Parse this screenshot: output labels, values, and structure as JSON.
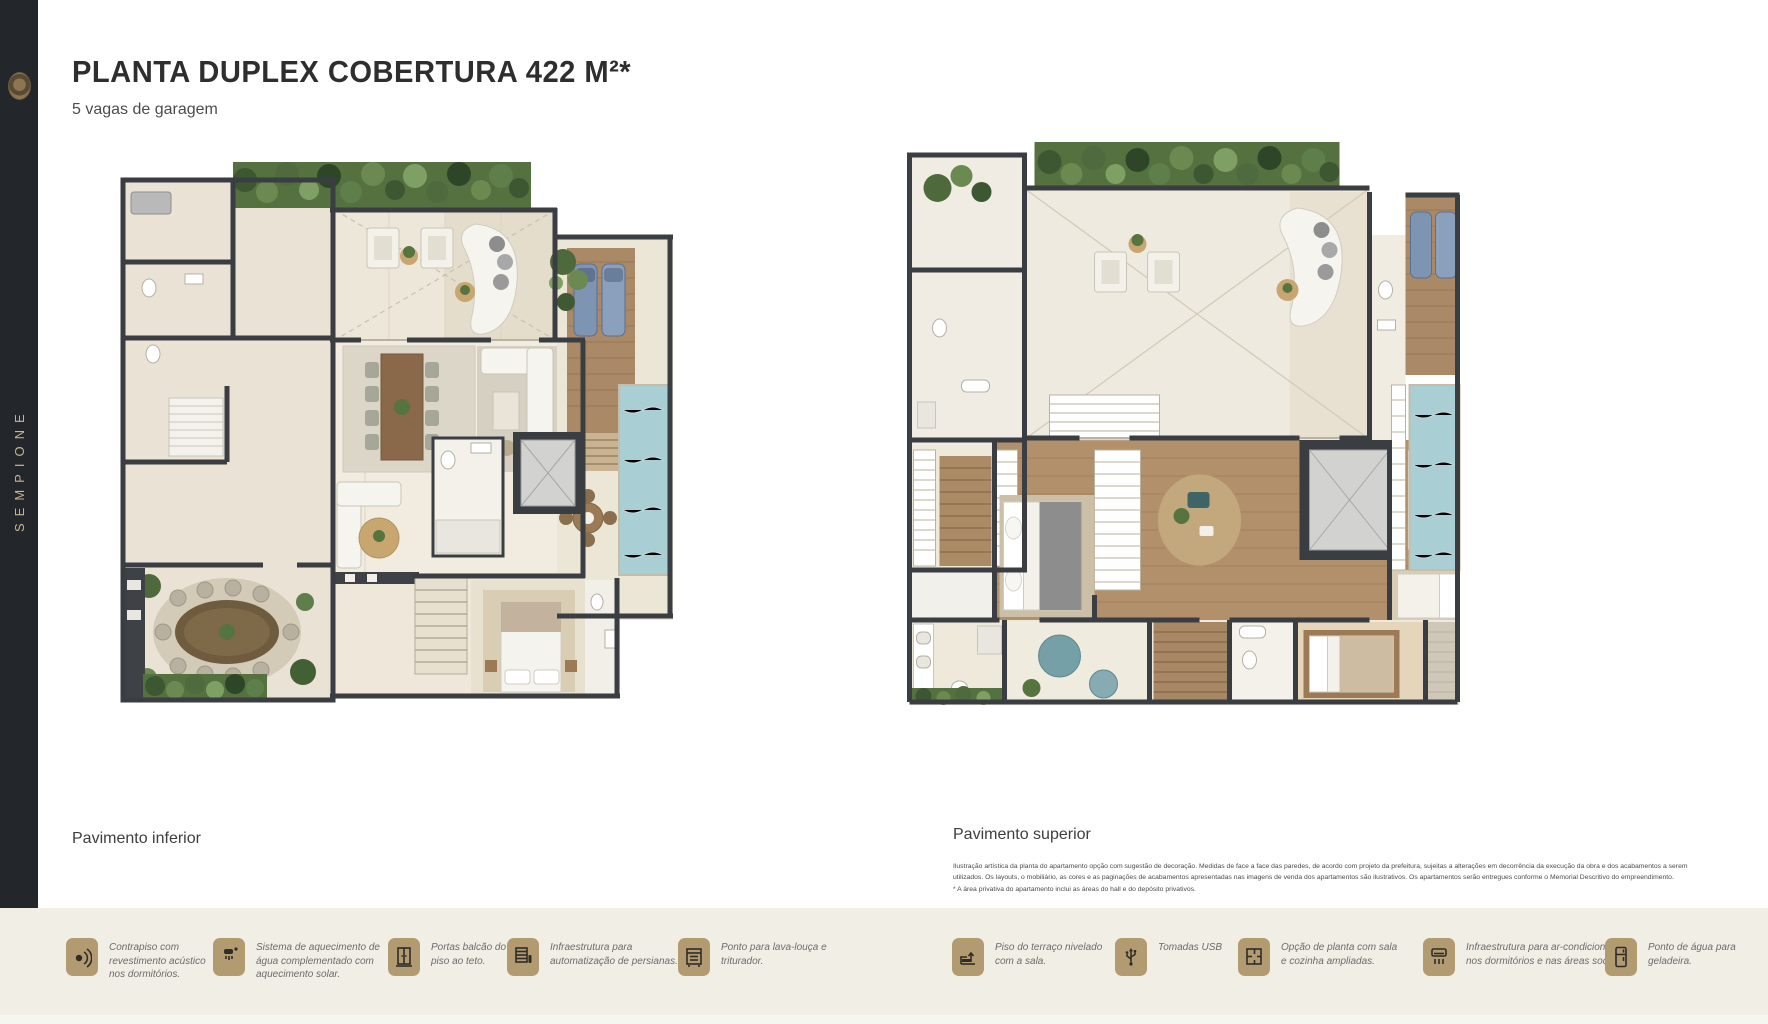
{
  "brand": {
    "name": "SEMPIONE"
  },
  "header": {
    "title": "PLANTA DUPLEX COBERTURA 422 M²*",
    "subtitle": "5 vagas de garagem"
  },
  "plans": {
    "inferior": {
      "label": "Pavimento inferior"
    },
    "superior": {
      "label": "Pavimento superior"
    }
  },
  "disclaimer": {
    "text": "Ilustração artística da planta do apartamento opção com sugestão de decoração. Medidas de face a face das paredes, de acordo com projeto da prefeitura, sujeitas a alterações em decorrência da execução da obra e dos acabamentos a serem utilizados. Os layouts, o mobiliário, as cores e as paginações de acabamentos apresentadas nas imagens de venda dos apartamentos são ilustrativos. Os apartamentos serão entregues conforme o Memorial Descritivo do empreendimento.",
    "note": "* A área privativa do apartamento inclui as áreas do hall e do depósito privativos."
  },
  "footer": {
    "features": [
      {
        "icon": "acoustic-floor-icon",
        "label": "Contrapiso com revestimento acústico nos dormitórios."
      },
      {
        "icon": "solar-water-heating-icon",
        "label": "Sistema de aquecimento de água complementado com aquecimento solar."
      },
      {
        "icon": "floor-to-ceiling-doors-icon",
        "label": "Portas balcão do piso ao teto."
      },
      {
        "icon": "blinds-automation-icon",
        "label": "Infraestrutura para automatização de persianas."
      },
      {
        "icon": "dishwasher-icon",
        "label": "Ponto para lava-louça e triturador."
      },
      {
        "icon": "terrace-level-icon",
        "label": "Piso do terraço nivelado com a sala."
      },
      {
        "icon": "usb-outlets-icon",
        "label": "Tomadas USB"
      },
      {
        "icon": "expanded-plan-icon",
        "label": "Opção de planta com sala e cozinha ampliadas."
      },
      {
        "icon": "air-conditioning-icon",
        "label": "Infraestrutura para ar-condicionado nos dormitórios e nas áreas sociais."
      },
      {
        "icon": "fridge-water-icon",
        "label": "Ponto de água para geladeira."
      }
    ]
  },
  "colors": {
    "sidebar_bg": "#23262b",
    "accent_gold": "#b39b71",
    "footer_bg": "#f1eee5",
    "wall": "#3a3d42",
    "pool": "#a9ced3",
    "wood_deck": "#aa8a66",
    "hedge_green": "#55713f"
  }
}
